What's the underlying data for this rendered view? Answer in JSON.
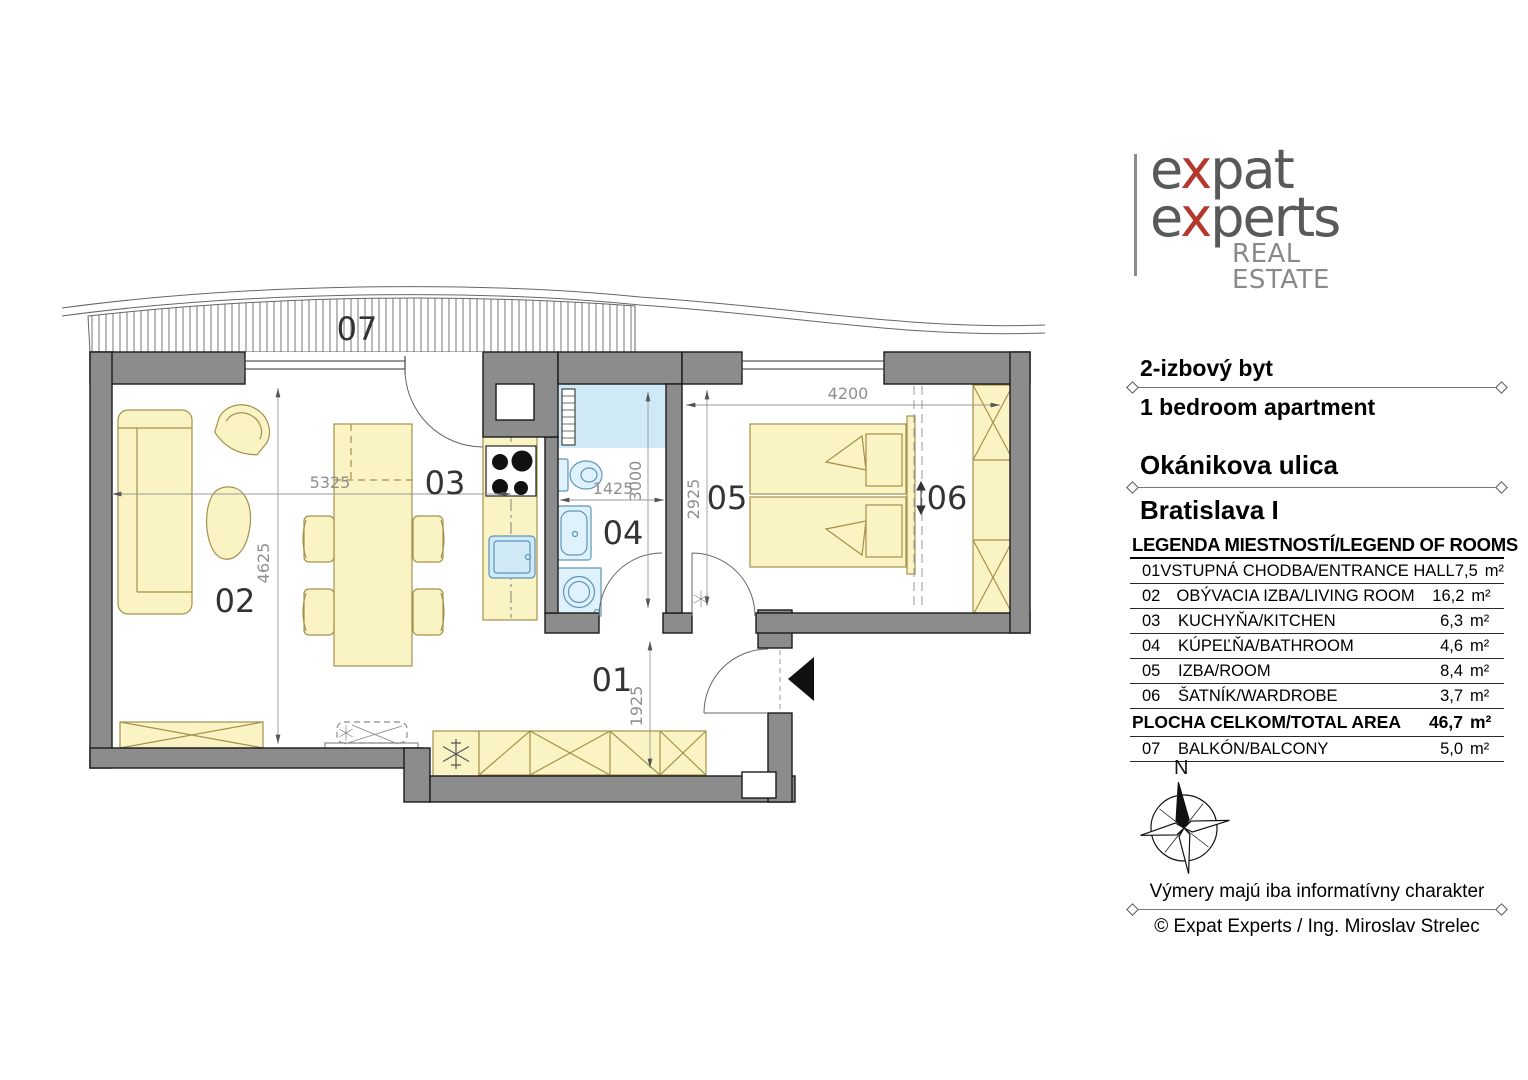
{
  "logo": {
    "word1_pre": "e",
    "word1_x": "x",
    "word1_post": "pat",
    "word2_pre": "e",
    "word2_x": "x",
    "word2_post": "perts",
    "subtitle": "REAL ESTATE"
  },
  "header": {
    "type_sk": "2-izbový byt",
    "type_en": "1 bedroom apartment",
    "street": "Okánikova ulica",
    "district": "Bratislava I"
  },
  "legend": {
    "title": "LEGENDA MIESTNOSTÍ/LEGEND OF ROOMS",
    "rows": [
      {
        "id": "01",
        "name": "VSTUPNÁ CHODBA/ENTRANCE HALL",
        "area": "7,5",
        "unit": "m²"
      },
      {
        "id": "02",
        "name": "OBÝVACIA IZBA/LIVING ROOM",
        "area": "16,2",
        "unit": "m²"
      },
      {
        "id": "03",
        "name": "KUCHYŇA/KITCHEN",
        "area": "6,3",
        "unit": "m²"
      },
      {
        "id": "04",
        "name": "KÚPEĽŇA/BATHROOM",
        "area": "4,6",
        "unit": "m²"
      },
      {
        "id": "05",
        "name": "IZBA/ROOM",
        "area": "8,4",
        "unit": "m²"
      },
      {
        "id": "06",
        "name": "ŠATNÍK/WARDROBE",
        "area": "3,7",
        "unit": "m²"
      }
    ],
    "total": {
      "label": "PLOCHA CELKOM/TOTAL AREA",
      "area": "46,7",
      "unit": "m²"
    },
    "extra": {
      "id": "07",
      "name": "BALKÓN/BALCONY",
      "area": "5,0",
      "unit": "m²"
    }
  },
  "plan": {
    "watermark": "expat",
    "rooms": {
      "r01": "01",
      "r02": "02",
      "r03": "03",
      "r04": "04",
      "r05": "05",
      "r06": "06",
      "r07": "07"
    },
    "dims": {
      "d5325": "5325",
      "d4625": "4625",
      "d1425": "1425",
      "d3000": "3000",
      "d2925": "2925",
      "d4200": "4200",
      "d1925": "1925"
    },
    "colors": {
      "wall": "#8c8c8c",
      "furniture": "#faf3c3",
      "furniture_outline": "#a3914c",
      "fixture": "#dff2fb",
      "fixture_outline": "#5d94b8",
      "accent_red": "#b5382f",
      "logo_gray": "#58595b"
    }
  },
  "compass": {
    "north": "N"
  },
  "footer": {
    "disclaimer": "Výmery majú iba informatívny charakter",
    "copyright": "© Expat Experts / Ing. Miroslav Strelec"
  }
}
